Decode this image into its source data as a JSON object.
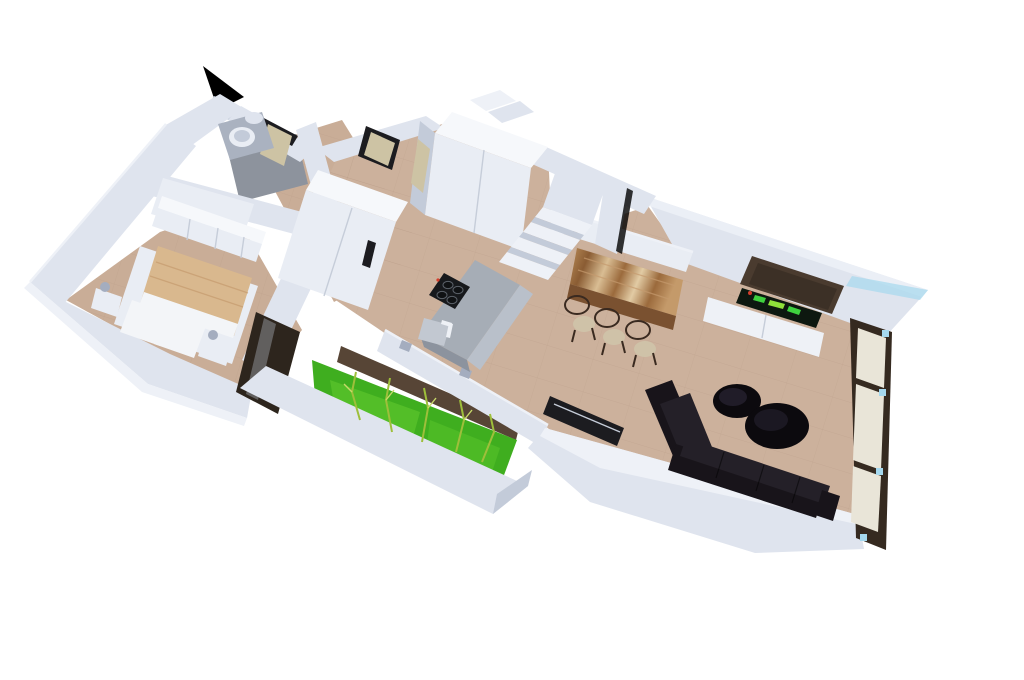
{
  "page": {
    "kind": "3d-floor-plan-render",
    "background": "#ffffff"
  },
  "colors": {
    "background": "#ffffff",
    "wall_top": "#eef1f7",
    "wall_lit": "#dfe4ee",
    "wall_mid": "#c3cbd9",
    "wall_shade": "#a4adbf",
    "white_furniture": "#e9edf4",
    "white_bright": "#f6f8fb",
    "floor_warm": "#ccb19c",
    "floor_bedroom": "#c9ad97",
    "tile_line": "#b2957f",
    "bath_floor": "#8d939d",
    "bath_fixture": "#aab2c0",
    "grass": "#3fae1f",
    "grass_light": "#64cc30",
    "soil": "#574536",
    "glass_dark": "#2d251d",
    "window_frame": "#352a20",
    "pane_beige": "#e9e5d8",
    "door_tan": "#cdc3a4",
    "door_gap": "#1c1c20",
    "island_top": "#a6adb6",
    "island_front": "#b9c0ca",
    "island_side": "#8c939e",
    "cooktop": "#17191c",
    "cooktop_ring": "#101214",
    "burner_ring": "#5a6068",
    "sink_inner": "#c2c8d1",
    "metal": "#eef1f6",
    "sofa": "#18141a",
    "sofa_cushion": "#242028",
    "coffee_table": "#0c0a0e",
    "coffee_table_sheen": "#262130",
    "tv_panel": "#4a3b2f",
    "tv_screen": "#0d1810",
    "tv_green_1": "#3fd13f",
    "tv_green_2": "#8fe03a",
    "tv_red": "#d43c2a",
    "blanket": "#d9b88e",
    "blanket_fold": "#c49a6e",
    "pillow": "#f3f5f8",
    "chair_seat": "#cfc2a8",
    "chair_frame": "#3a2a20",
    "wood_dark": "#7a5130",
    "wood_1": "#b98c58",
    "wood_2": "#8a5c33",
    "wood_3": "#d9bd93",
    "wood_4": "#9b6a3c",
    "wood_5": "#e2cba4",
    "wood_6": "#c49a6a",
    "clip_blue": "#a5d8ee",
    "black": "#000000",
    "seam": "#c6cdd9",
    "plant_stem": "#9ebf3b",
    "plant_leaf": "#c8d96a"
  },
  "scene": {
    "rooms": [
      {
        "name": "bathroom"
      },
      {
        "name": "bedroom"
      },
      {
        "name": "hallway"
      },
      {
        "name": "kitchen"
      },
      {
        "name": "dining-area"
      },
      {
        "name": "living-room"
      },
      {
        "name": "courtyard-garden"
      },
      {
        "name": "staircase"
      }
    ],
    "furniture": [
      {
        "name": "bathtub"
      },
      {
        "name": "vanity-sink"
      },
      {
        "name": "toilet"
      },
      {
        "name": "double-bed"
      },
      {
        "name": "nightstand-left"
      },
      {
        "name": "nightstand-right"
      },
      {
        "name": "bedroom-wardrobe"
      },
      {
        "name": "tall-cabinet"
      },
      {
        "name": "hall-wardrobe"
      },
      {
        "name": "kitchen-island"
      },
      {
        "name": "cooktop"
      },
      {
        "name": "kitchen-sink"
      },
      {
        "name": "dining-table"
      },
      {
        "name": "dining-chairs",
        "count": 3
      },
      {
        "name": "tv-wall-panel"
      },
      {
        "name": "tv-screen"
      },
      {
        "name": "media-console"
      },
      {
        "name": "sectional-sofa"
      },
      {
        "name": "coffee-table-small"
      },
      {
        "name": "coffee-table-large"
      },
      {
        "name": "bamboo-plants"
      }
    ]
  }
}
